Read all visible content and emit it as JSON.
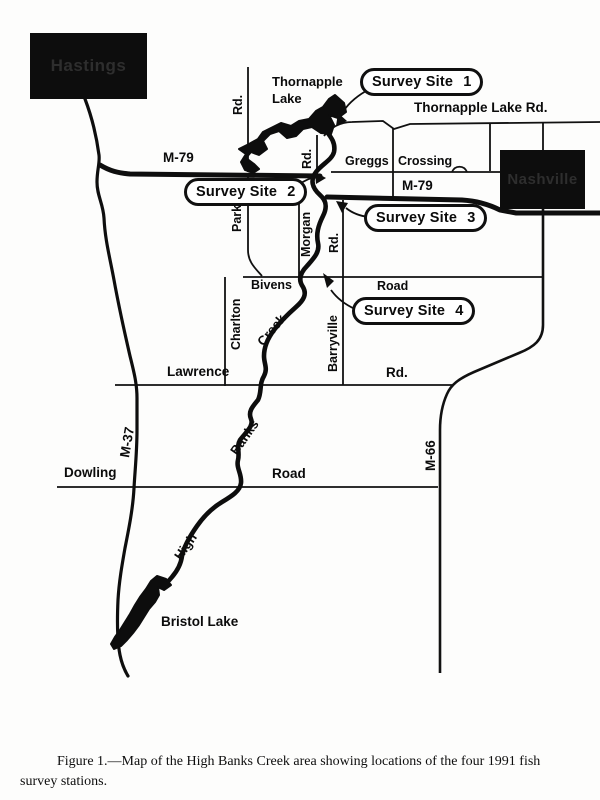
{
  "map": {
    "cities": {
      "hastings": "Hastings",
      "nashville": "Nashville"
    },
    "lakes": {
      "thornapple_line1": "Thornapple",
      "thornapple_line2": "Lake",
      "bristol": "Bristol Lake"
    },
    "survey_sites": {
      "site1": {
        "name": "Survey Site",
        "number": "1"
      },
      "site2": {
        "name": "Survey Site",
        "number": "2"
      },
      "site3": {
        "name": "Survey Site",
        "number": "3"
      },
      "site4": {
        "name": "Survey Site",
        "number": "4"
      }
    },
    "roads": {
      "thornapple_lake_rd": "Thornapple Lake Rd.",
      "greggs": "Greggs",
      "crossing": "Crossing",
      "m79_west": "M-79",
      "m79_east": "M-79",
      "m37": "M-37",
      "m66": "M-66",
      "park_rd_top": "Rd.",
      "park": "Park",
      "lake_rd": "Rd.",
      "morgan": "Morgan",
      "morgan_rd": "Rd.",
      "bivens": "Bivens",
      "bivens_road": "Road",
      "charlton": "Charlton",
      "barryville": "Barryville",
      "lawrence": "Lawrence",
      "lawrence_rd": "Rd.",
      "dowling": "Dowling",
      "dowling_road": "Road"
    },
    "creek": {
      "high": "High",
      "banks": "Banks",
      "creek": "Creek"
    }
  },
  "colors": {
    "ink": "#0d0d0d",
    "paper": "#fdfdfc"
  },
  "figure": {
    "caption_line1": "Figure 1.—Map of the High Banks Creek area showing locations of the four 1991 fish",
    "caption_line2": "survey stations."
  }
}
